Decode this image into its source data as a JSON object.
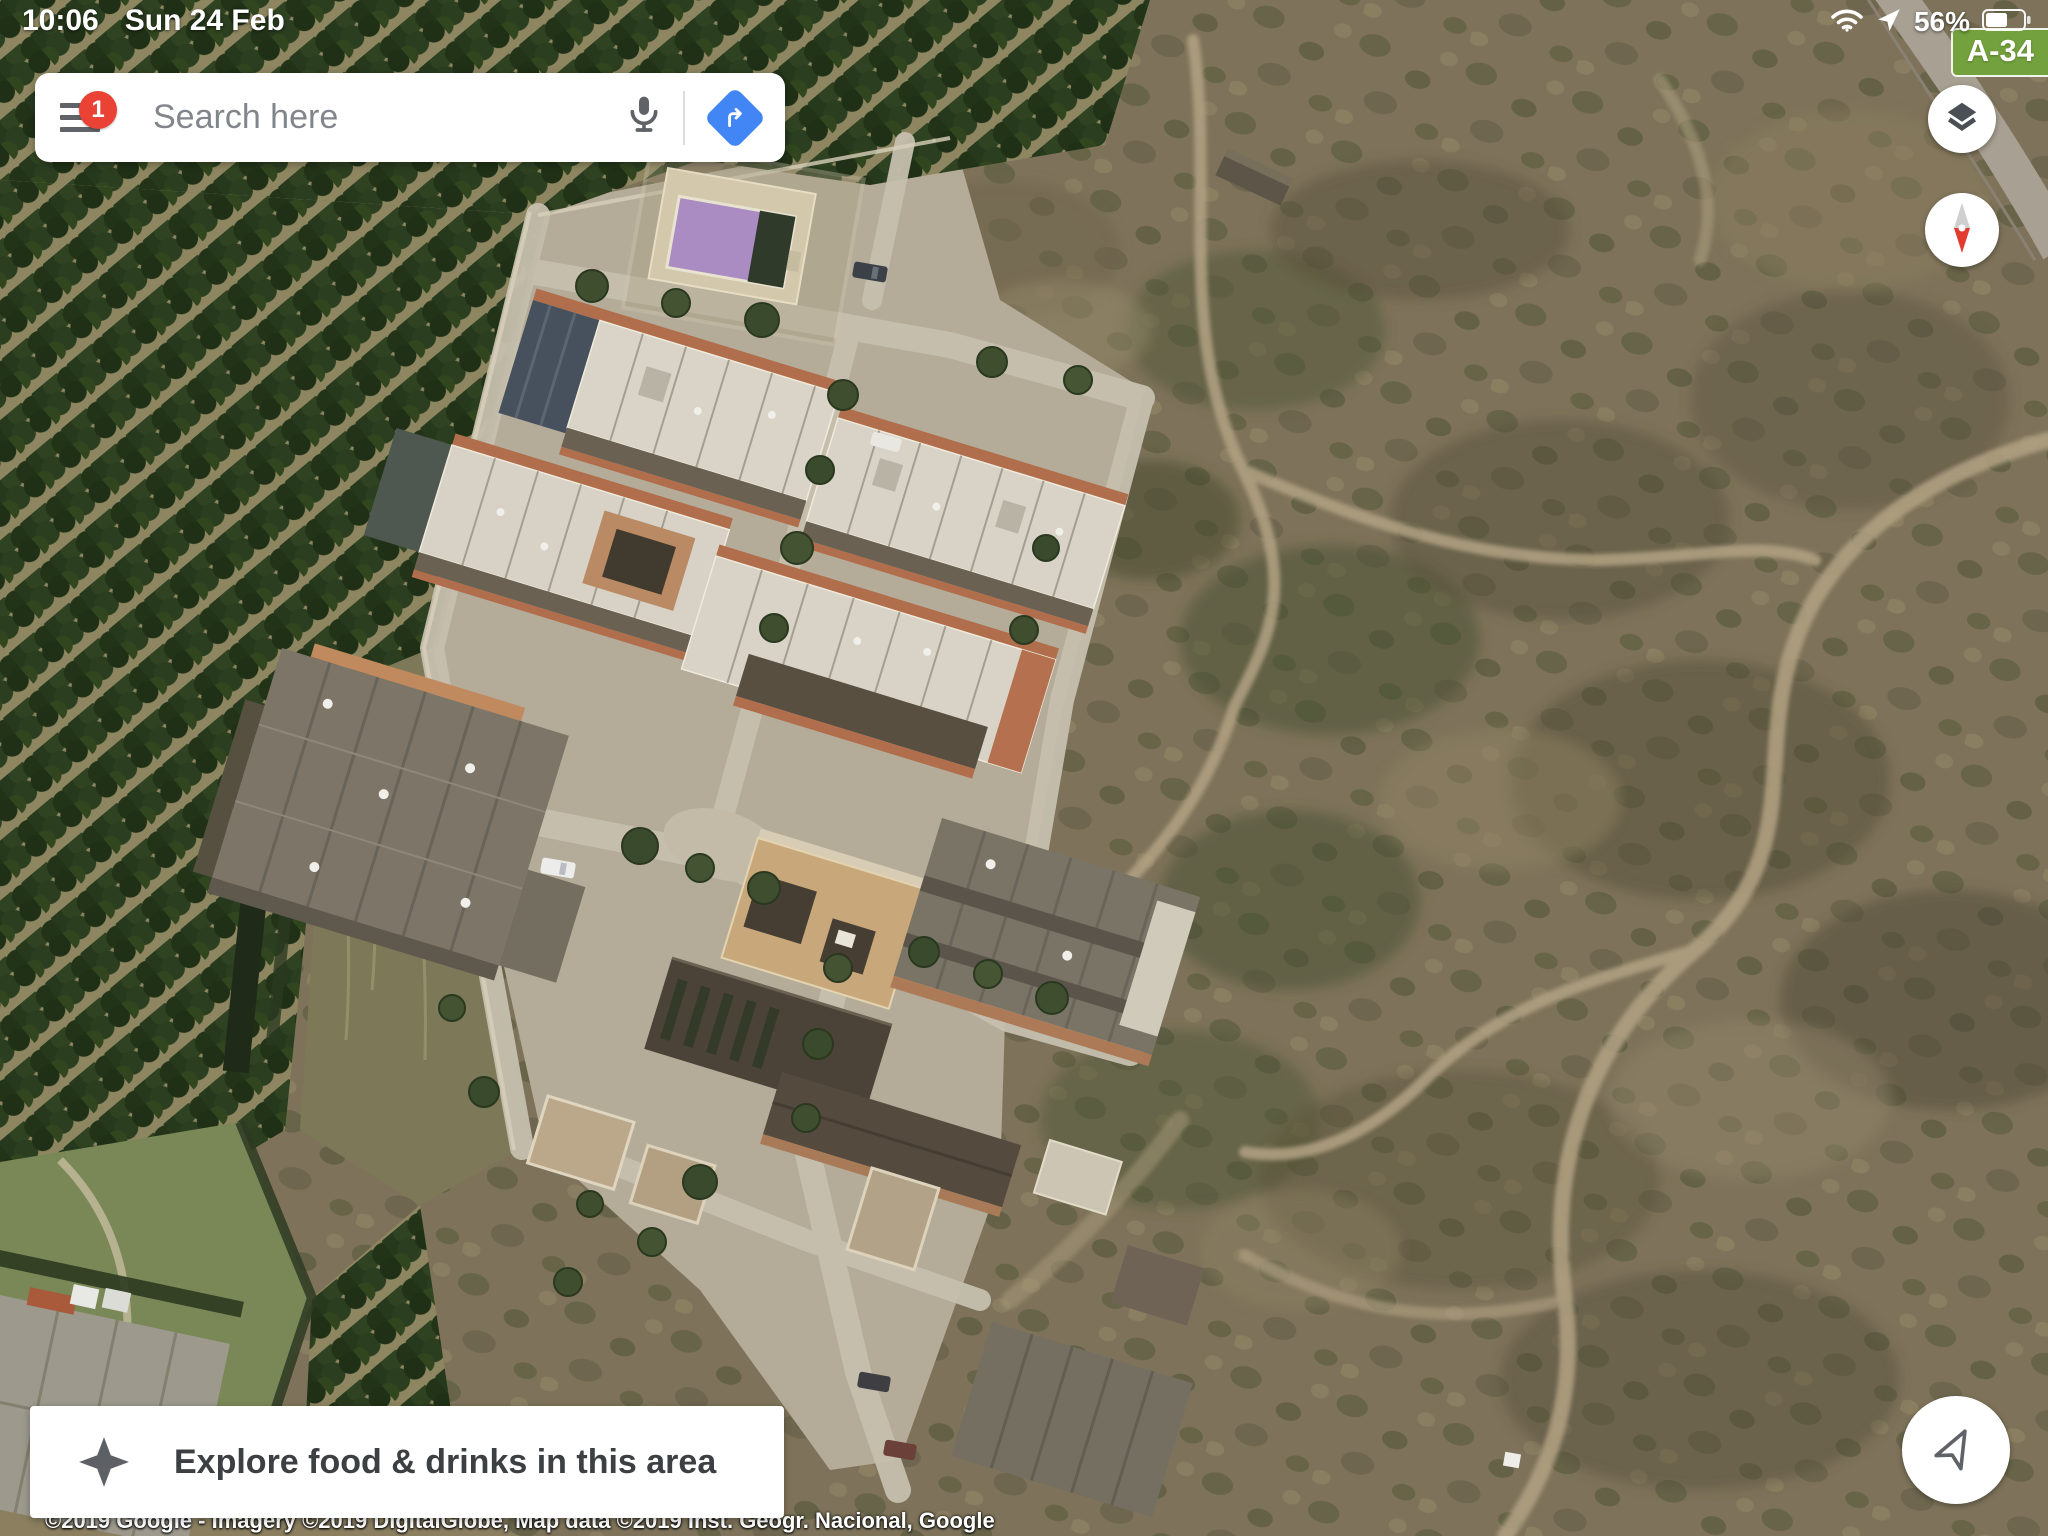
{
  "status_bar": {
    "time": "10:06",
    "date": "Sun 24 Feb",
    "battery_percent": "56%"
  },
  "map": {
    "road_badge": "A-34",
    "view_type": "satellite"
  },
  "search_bar": {
    "placeholder": "Search here",
    "notification_count": "1"
  },
  "explore_bar": {
    "label": "Explore food & drinks in this area"
  },
  "attribution": "©2019 Google - Imagery ©2019 DigitalGlobe, Map data ©2019 Inst. Geogr. Nacional, Google",
  "colors": {
    "directions_blue": "#4285f4",
    "notification_red": "#ea4335",
    "road_badge_green": "#73a13d",
    "compass_red": "#e23b30",
    "pool_purple": "#ab8cc2"
  }
}
